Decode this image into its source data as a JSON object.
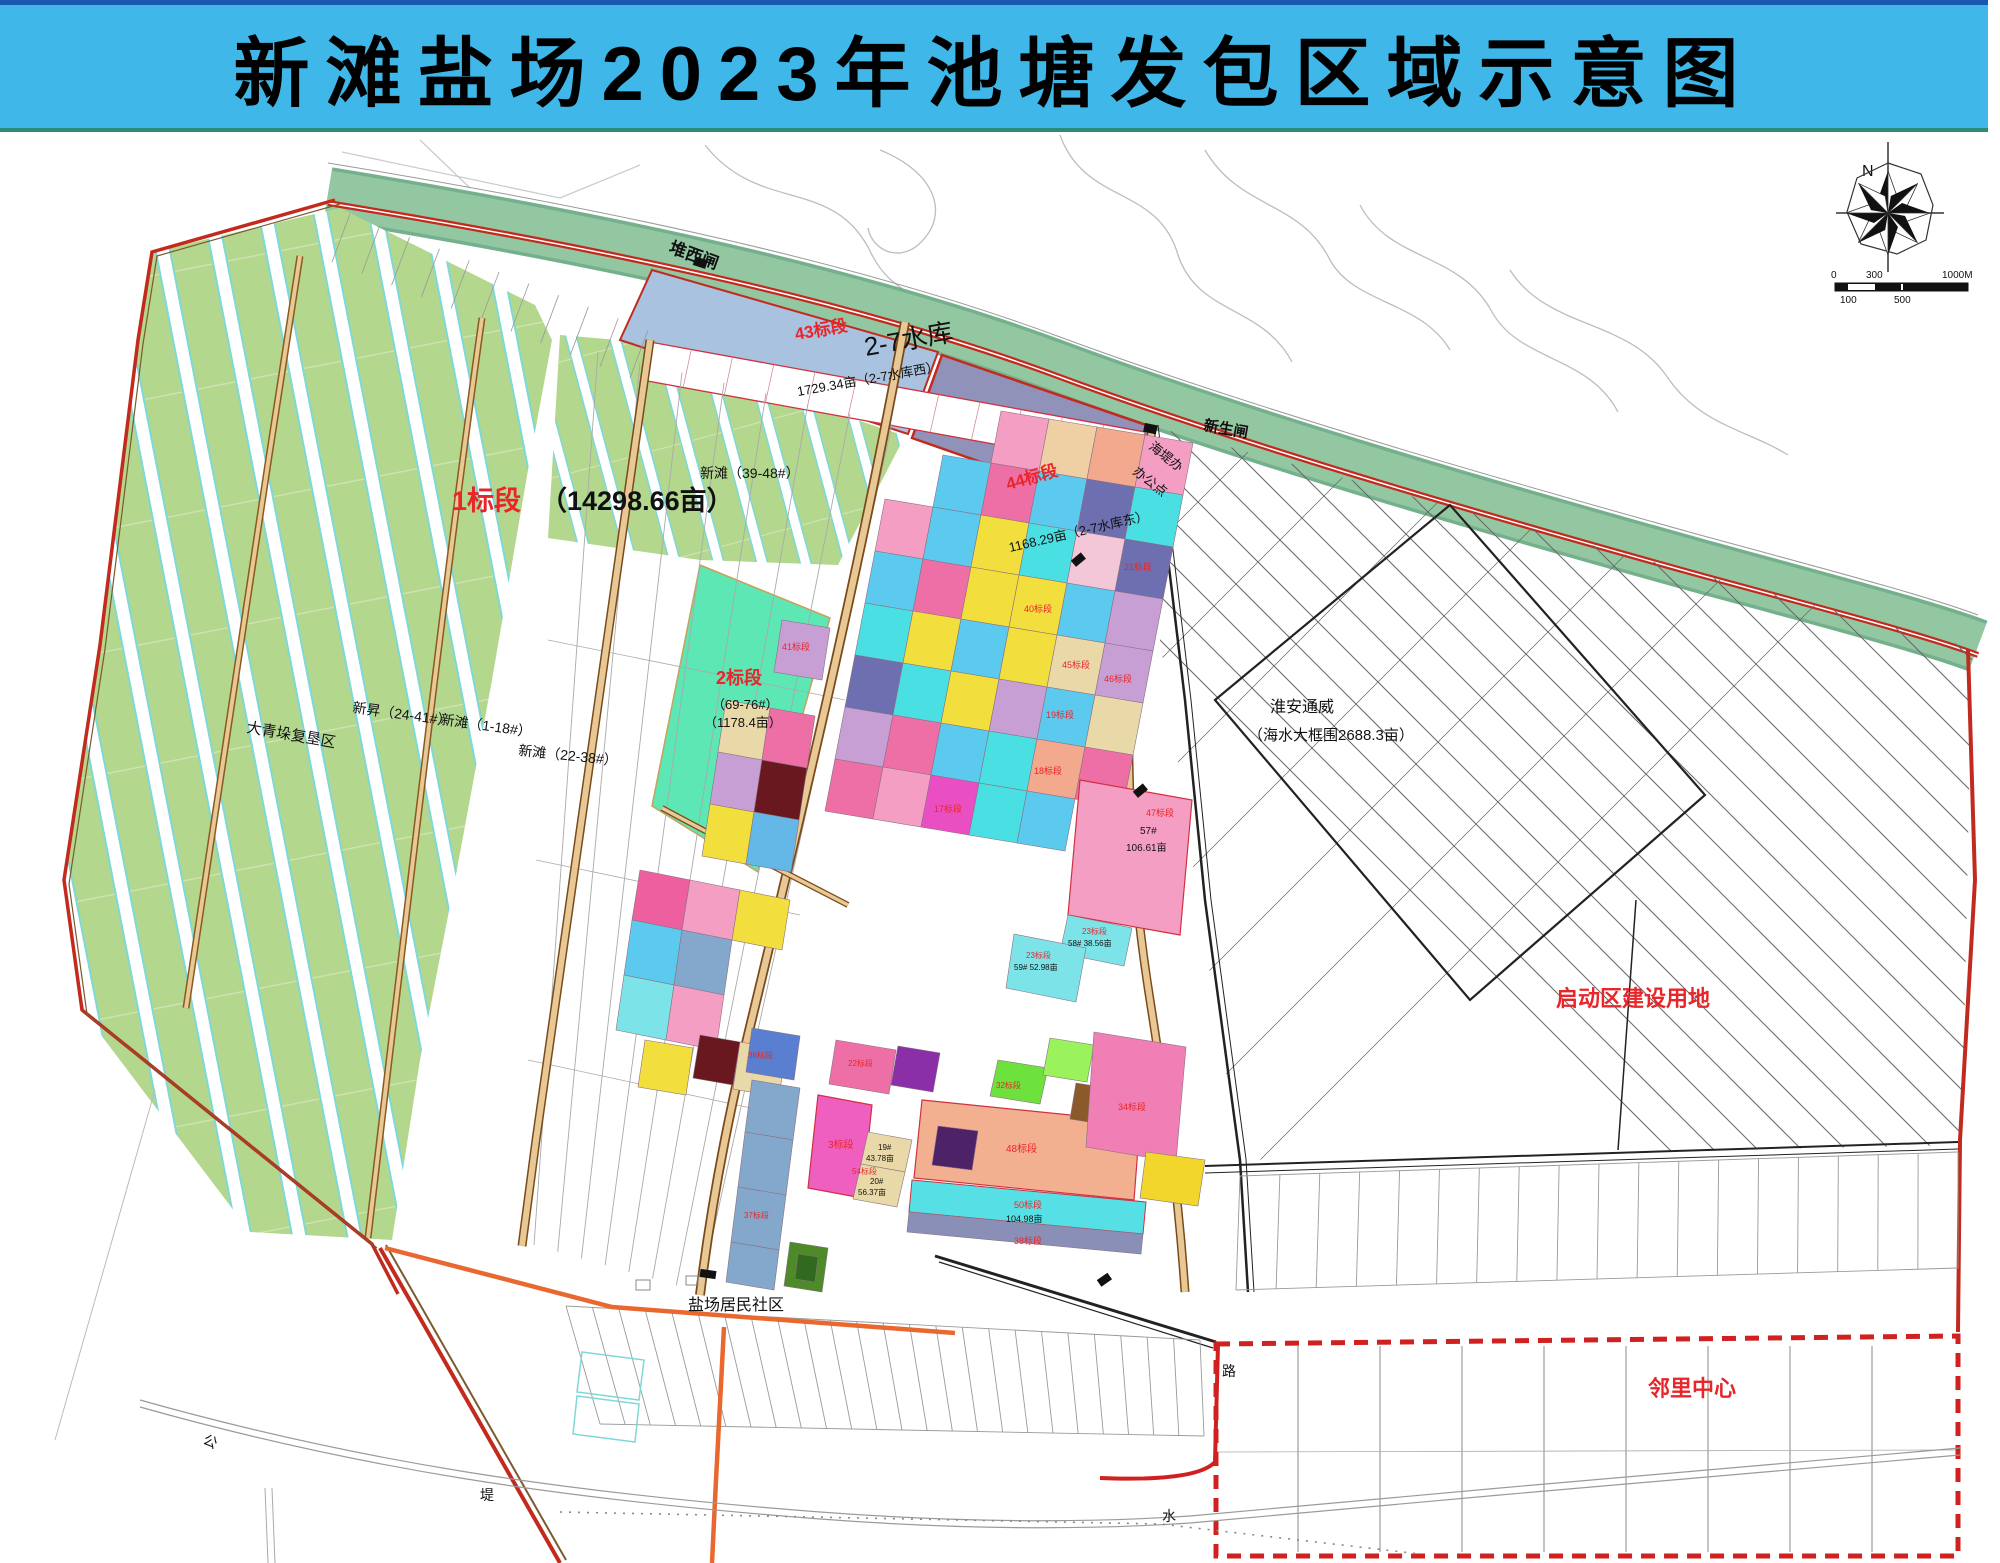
{
  "banner": {
    "title": "新滩盐场2023年池塘发包区域示意图",
    "bg_color": "#3FB7E9"
  },
  "compass": {
    "north_label": "N"
  },
  "scale_bar": {
    "t0": "0",
    "t300": "300",
    "t1000": "1000M",
    "b100": "100",
    "b500": "500"
  },
  "map": {
    "colors": {
      "banner_blue": "#3FB7E9",
      "dike_green": "#93C7A2",
      "farm_green": "#B3D78C",
      "strip_edge_cyan": "#7FD8D8",
      "reservoir_blue": "#A8C2DF",
      "bid44_purple": "#9092BA",
      "mint_green": "#5CE7B4",
      "boundary_red": "#C22A1E",
      "label_red": "#E8262A",
      "road_tan": "#E8C894",
      "road_orange": "#E86830"
    },
    "labels": [
      {
        "text": "堆西闸",
        "x": 668,
        "y": 252,
        "size": 17,
        "rot": 20,
        "bold": true
      },
      {
        "text": "新生闸",
        "x": 1203,
        "y": 430,
        "size": 15,
        "rot": 10,
        "bold": true
      },
      {
        "text": "海堤办",
        "x": 1148,
        "y": 448,
        "size": 13,
        "rot": 38
      },
      {
        "text": "办公点",
        "x": 1132,
        "y": 473,
        "size": 13,
        "rot": 38
      },
      {
        "text": "43标段",
        "x": 796,
        "y": 340,
        "size": 17,
        "color": "#E8262A",
        "rot": -10,
        "bold": true
      },
      {
        "text": "2-7水库",
        "x": 866,
        "y": 356,
        "size": 26,
        "rot": -10
      },
      {
        "text": "1729.34亩（2-7水库西）",
        "x": 798,
        "y": 396,
        "size": 13,
        "rot": -10
      },
      {
        "text": "44标段",
        "x": 1008,
        "y": 490,
        "size": 17,
        "color": "#E8262A",
        "rot": -16,
        "bold": true
      },
      {
        "text": "1168.29亩（2-7水库东）",
        "x": 1010,
        "y": 552,
        "size": 13,
        "rot": -13
      },
      {
        "text": "新滩（39-48#）",
        "x": 700,
        "y": 478,
        "size": 14
      },
      {
        "text": "1标段",
        "x": 452,
        "y": 510,
        "size": 27,
        "color": "#E8262A",
        "bold": true
      },
      {
        "text": "（14298.66亩）",
        "x": 540,
        "y": 510,
        "size": 27,
        "bold": true
      },
      {
        "text": "大青垛复垦区",
        "x": 246,
        "y": 732,
        "size": 15,
        "rot": 10
      },
      {
        "text": "新昇（24-41#）",
        "x": 352,
        "y": 712,
        "size": 14,
        "rot": 8
      },
      {
        "text": "新滩（1-18#）",
        "x": 440,
        "y": 724,
        "size": 14,
        "rot": 8
      },
      {
        "text": "新滩（22-38#）",
        "x": 518,
        "y": 755,
        "size": 14,
        "rot": 6
      },
      {
        "text": "2标段",
        "x": 716,
        "y": 684,
        "size": 18,
        "color": "#E8262A",
        "bold": true
      },
      {
        "text": "（69-76#）",
        "x": 712,
        "y": 709,
        "size": 13
      },
      {
        "text": "（1178.4亩）",
        "x": 704,
        "y": 727,
        "size": 13
      },
      {
        "text": "淮安通威",
        "x": 1270,
        "y": 712,
        "size": 16
      },
      {
        "text": "（海水大框围2688.3亩）",
        "x": 1248,
        "y": 740,
        "size": 15
      },
      {
        "text": "启动区建设用地",
        "x": 1556,
        "y": 1006,
        "size": 22,
        "color": "#E8262A",
        "bold": true
      },
      {
        "text": "盐场居民社区",
        "x": 688,
        "y": 1310,
        "size": 16
      },
      {
        "text": "邻里中心",
        "x": 1648,
        "y": 1396,
        "size": 22,
        "color": "#E8262A",
        "bold": true
      },
      {
        "text": "路",
        "x": 1222,
        "y": 1376,
        "size": 14
      },
      {
        "text": "水",
        "x": 1162,
        "y": 1521,
        "size": 14
      },
      {
        "text": "公",
        "x": 202,
        "y": 1443,
        "size": 14,
        "rot": 25
      },
      {
        "text": "堤",
        "x": 480,
        "y": 1500,
        "size": 14
      },
      {
        "text": "57#",
        "x": 1140,
        "y": 834,
        "size": 10
      },
      {
        "text": "106.61亩",
        "x": 1126,
        "y": 851,
        "size": 10
      },
      {
        "text": "47标段",
        "x": 1146,
        "y": 816,
        "size": 9,
        "color": "#E8262A"
      },
      {
        "text": "23标段",
        "x": 1082,
        "y": 934,
        "size": 8,
        "color": "#E8262A"
      },
      {
        "text": "58# 38.56亩",
        "x": 1068,
        "y": 946,
        "size": 8
      },
      {
        "text": "23标段",
        "x": 1026,
        "y": 958,
        "size": 8,
        "color": "#E8262A"
      },
      {
        "text": "59# 52.98亩",
        "x": 1014,
        "y": 970,
        "size": 8
      },
      {
        "text": "40标段",
        "x": 1024,
        "y": 612,
        "size": 9,
        "color": "#E8262A"
      },
      {
        "text": "41标段",
        "x": 782,
        "y": 650,
        "size": 9,
        "color": "#E8262A"
      },
      {
        "text": "45标段",
        "x": 1062,
        "y": 668,
        "size": 9,
        "color": "#E8262A"
      },
      {
        "text": "46标段",
        "x": 1104,
        "y": 682,
        "size": 9,
        "color": "#E8262A"
      },
      {
        "text": "21标段",
        "x": 1124,
        "y": 570,
        "size": 9,
        "color": "#E8262A"
      },
      {
        "text": "18标段",
        "x": 1034,
        "y": 774,
        "size": 9,
        "color": "#E8262A"
      },
      {
        "text": "19标段",
        "x": 1046,
        "y": 718,
        "size": 9,
        "color": "#E8262A"
      },
      {
        "text": "17标段",
        "x": 934,
        "y": 812,
        "size": 9,
        "color": "#E8262A"
      },
      {
        "text": "3标段",
        "x": 828,
        "y": 1148,
        "size": 10,
        "color": "#E8262A"
      },
      {
        "text": "19#",
        "x": 878,
        "y": 1150,
        "size": 8
      },
      {
        "text": "43.78亩",
        "x": 866,
        "y": 1161,
        "size": 8
      },
      {
        "text": "20#",
        "x": 870,
        "y": 1184,
        "size": 8
      },
      {
        "text": "56.37亩",
        "x": 858,
        "y": 1195,
        "size": 8
      },
      {
        "text": "48标段",
        "x": 1006,
        "y": 1152,
        "size": 10,
        "color": "#E8262A"
      },
      {
        "text": "50标段",
        "x": 1014,
        "y": 1208,
        "size": 9,
        "color": "#E8262A"
      },
      {
        "text": "104.98亩",
        "x": 1006,
        "y": 1222,
        "size": 9
      },
      {
        "text": "38标段",
        "x": 1014,
        "y": 1244,
        "size": 9,
        "color": "#E8262A"
      },
      {
        "text": "32标段",
        "x": 996,
        "y": 1088,
        "size": 8,
        "color": "#E8262A"
      },
      {
        "text": "34标段",
        "x": 1118,
        "y": 1110,
        "size": 9,
        "color": "#E8262A"
      },
      {
        "text": "22标段",
        "x": 848,
        "y": 1066,
        "size": 8,
        "color": "#E8262A"
      },
      {
        "text": "37标段",
        "x": 744,
        "y": 1218,
        "size": 8,
        "color": "#E8262A"
      },
      {
        "text": "54标段",
        "x": 852,
        "y": 1174,
        "size": 8,
        "color": "#E8262A"
      },
      {
        "text": "36标段",
        "x": 748,
        "y": 1058,
        "size": 8,
        "color": "#E8262A"
      }
    ],
    "parcels": [
      {
        "pts": "1001,411 1049,419 1039,471 991,463",
        "fill": "#F59EC4"
      },
      {
        "pts": "1049,419 1097,427 1087,479 1039,471",
        "fill": "#EFCFA4"
      },
      {
        "pts": "1097,427 1145,435 1135,487 1087,479",
        "fill": "#F2A98E"
      },
      {
        "pts": "1145,435 1193,443 1183,495 1135,487",
        "fill": "#F59EC4"
      },
      {
        "pts": "943,455 991,463 981,515 933,507",
        "fill": "#5CC9EE"
      },
      {
        "pts": "991,463 1039,471 1029,523 981,515",
        "fill": "#EE6FA5"
      },
      {
        "pts": "1039,471 1087,479 1077,531 1029,523",
        "fill": "#5CC9EE"
      },
      {
        "pts": "1087,479 1135,487 1125,539 1077,531",
        "fill": "#6D6FB0"
      },
      {
        "pts": "1135,487 1183,495 1173,547 1125,539",
        "fill": "#4ADFE2"
      },
      {
        "pts": "885,499 933,507 923,559 875,551",
        "fill": "#F59EC4"
      },
      {
        "pts": "933,507 981,515 971,567 923,559",
        "fill": "#5CC9EE"
      },
      {
        "pts": "981,515 1029,523 1019,575 971,567",
        "fill": "#F2DE3C"
      },
      {
        "pts": "1029,523 1077,531 1067,583 1019,575",
        "fill": "#4ADFE2"
      },
      {
        "pts": "1077,531 1125,539 1115,591 1067,583",
        "fill": "#F3C6D8"
      },
      {
        "pts": "1125,539 1173,547 1163,599 1115,591",
        "fill": "#6D6FB0"
      },
      {
        "pts": "875,551 923,559 913,611 865,603",
        "fill": "#5CC9EE"
      },
      {
        "pts": "923,559 971,567 961,619 913,611",
        "fill": "#EE6FA5"
      },
      {
        "pts": "971,567 1019,575 1009,627 961,619",
        "fill": "#F2DE3C"
      },
      {
        "pts": "1019,575 1067,583 1057,635 1009,627",
        "fill": "#F2DE3C"
      },
      {
        "pts": "1067,583 1115,591 1105,643 1057,635",
        "fill": "#5CC9EE"
      },
      {
        "pts": "1115,591 1163,599 1153,651 1105,643",
        "fill": "#C79FD4"
      },
      {
        "pts": "865,603 913,611 903,663 855,655",
        "fill": "#4ADFE2"
      },
      {
        "pts": "913,611 961,619 951,671 903,663",
        "fill": "#F2DE3C"
      },
      {
        "pts": "961,619 1009,627 999,679 951,671",
        "fill": "#5CC9EE"
      },
      {
        "pts": "1009,627 1057,635 1047,687 999,679",
        "fill": "#F2DE3C"
      },
      {
        "pts": "1057,635 1105,643 1095,695 1047,687",
        "fill": "#EAD9A8"
      },
      {
        "pts": "1105,643 1153,651 1143,703 1095,695",
        "fill": "#C79FD4"
      },
      {
        "pts": "855,655 903,663 893,715 845,707",
        "fill": "#6D6FB0"
      },
      {
        "pts": "903,663 951,671 941,723 893,715",
        "fill": "#4ADFE2"
      },
      {
        "pts": "951,671 999,679 989,731 941,723",
        "fill": "#F2DE3C"
      },
      {
        "pts": "999,679 1047,687 1037,739 989,731",
        "fill": "#C79FD4"
      },
      {
        "pts": "1047,687 1095,695 1085,747 1037,739",
        "fill": "#5CC9EE"
      },
      {
        "pts": "1095,695 1143,703 1133,755 1085,747",
        "fill": "#EAD9A8"
      },
      {
        "pts": "845,707 893,715 883,767 835,759",
        "fill": "#C79FD4"
      },
      {
        "pts": "893,715 941,723 931,775 883,767",
        "fill": "#EE6FA5"
      },
      {
        "pts": "941,723 989,731 979,783 931,775",
        "fill": "#5CC9EE"
      },
      {
        "pts": "989,731 1037,739 1027,791 979,783",
        "fill": "#4ADFE2"
      },
      {
        "pts": "1037,739 1085,747 1075,799 1027,791",
        "fill": "#F2A98E"
      },
      {
        "pts": "1085,747 1133,755 1123,807 1075,799",
        "fill": "#EE6FA5"
      },
      {
        "pts": "835,759 883,767 873,819 825,811",
        "fill": "#EE6FA5"
      },
      {
        "pts": "883,767 931,775 921,827 873,819",
        "fill": "#F59EC4"
      },
      {
        "pts": "931,775 979,783 969,835 921,827",
        "fill": "#E94FC3"
      },
      {
        "pts": "979,783 1027,791 1017,843 969,835",
        "fill": "#4ADFE2"
      },
      {
        "pts": "1027,791 1075,799 1065,851 1017,843",
        "fill": "#5CC9EE"
      },
      {
        "pts": "1080,780 1192,800 1180,935 1068,915",
        "fill": "#F59EC4",
        "stroke": "#D03040",
        "sw": 1.2
      },
      {
        "pts": "1068,915 1132,928 1124,966 1060,953",
        "fill": "#7CE4E8"
      },
      {
        "pts": "1014,934 1086,948 1076,1002 1006,988",
        "fill": "#7CE4E8"
      },
      {
        "pts": "782,620 830,628 822,680 774,672",
        "fill": "#C79FD4"
      },
      {
        "pts": "726,700 770,708 762,760 718,752",
        "fill": "#EAD9A8"
      },
      {
        "pts": "770,708 815,716 807,768 762,760",
        "fill": "#EE6FA5"
      },
      {
        "pts": "718,752 762,760 754,812 710,804",
        "fill": "#C79FD4"
      },
      {
        "pts": "762,760 807,768 799,820 754,812",
        "fill": "#6A1820"
      },
      {
        "pts": "710,804 754,812 746,864 702,856",
        "fill": "#F2DE3C"
      },
      {
        "pts": "754,812 799,820 791,872 746,864",
        "fill": "#64B8E8"
      },
      {
        "pts": "640,870 690,880 682,930 632,920",
        "fill": "#EE5FA0"
      },
      {
        "pts": "690,880 740,890 732,940 682,930",
        "fill": "#F59EC4"
      },
      {
        "pts": "740,890 790,900 782,950 732,940",
        "fill": "#F2DE3C"
      },
      {
        "pts": "632,920 682,930 674,985 624,975",
        "fill": "#5CC9EE"
      },
      {
        "pts": "682,930 732,940 724,995 674,985",
        "fill": "#84A7CC"
      },
      {
        "pts": "624,975 674,985 666,1040 616,1030",
        "fill": "#7CE4E8"
      },
      {
        "pts": "674,985 724,995 716,1050 666,1040",
        "fill": "#F59EC4"
      },
      {
        "pts": "645,1040 693,1048 686,1095 638,1087",
        "fill": "#F2DE3C"
      },
      {
        "pts": "700,1035 740,1042 733,1085 693,1078",
        "fill": "#6A1820"
      },
      {
        "pts": "740,1042 786,1050 779,1097 733,1089",
        "fill": "#EAD9A8"
      },
      {
        "pts": "752,1028 800,1036 794,1080 746,1072",
        "fill": "#5A7FD0"
      },
      {
        "pts": "752,1080 800,1088 793,1140 745,1132",
        "fill": "#84A7CC"
      },
      {
        "pts": "745,1132 793,1140 786,1195 738,1187",
        "fill": "#84A7CC"
      },
      {
        "pts": "738,1187 786,1195 779,1250 731,1242",
        "fill": "#84A7CC"
      },
      {
        "pts": "731,1242 779,1250 774,1290 726,1282",
        "fill": "#84A7CC"
      },
      {
        "pts": "836,1040 896,1050 889,1094 829,1084",
        "fill": "#EE6FA5"
      },
      {
        "pts": "898,1046 940,1053 933,1092 891,1085",
        "fill": "#8A2FA8"
      },
      {
        "pts": "818,1095 872,1105 862,1198 808,1188",
        "fill": "#EE5FC0",
        "stroke": "#D03040",
        "sw": 1.2
      },
      {
        "pts": "868,1132 912,1140 905,1172 861,1164",
        "fill": "#EAD9A8"
      },
      {
        "pts": "861,1164 905,1172 897,1207 853,1199",
        "fill": "#EAD9A8"
      },
      {
        "pts": "922,1100 1140,1122 1134,1200 914,1178",
        "fill": "#F2B090",
        "stroke": "#D03040",
        "sw": 1.2
      },
      {
        "pts": "938,1126 978,1131 972,1170 932,1165",
        "fill": "#4E2266"
      },
      {
        "pts": "912,1180 1146,1202 1143,1234 909,1212",
        "fill": "#56E0E6",
        "stroke": "#D03040",
        "sw": 1
      },
      {
        "pts": "909,1212 1143,1234 1141,1254 907,1232",
        "fill": "#8A8FB8"
      },
      {
        "pts": "998,1060 1048,1068 1040,1104 990,1096",
        "fill": "#6EE23C"
      },
      {
        "pts": "1050,1038 1094,1045 1087,1082 1043,1075",
        "fill": "#9AF25C"
      },
      {
        "pts": "1076,1083 1107,1088 1101,1124 1070,1119",
        "fill": "#8A5A2A"
      },
      {
        "pts": "1094,1032 1186,1047 1176,1162 1086,1147",
        "fill": "#F07FB5"
      },
      {
        "pts": "1146,1152 1205,1160 1198,1206 1140,1198",
        "fill": "#F2D62C"
      },
      {
        "pts": "790,1242 828,1248 822,1292 784,1286",
        "fill": "#4E8A28"
      },
      {
        "pts": "798,1254 818,1257 815,1282 795,1279",
        "fill": "#2F6A1E"
      }
    ]
  }
}
